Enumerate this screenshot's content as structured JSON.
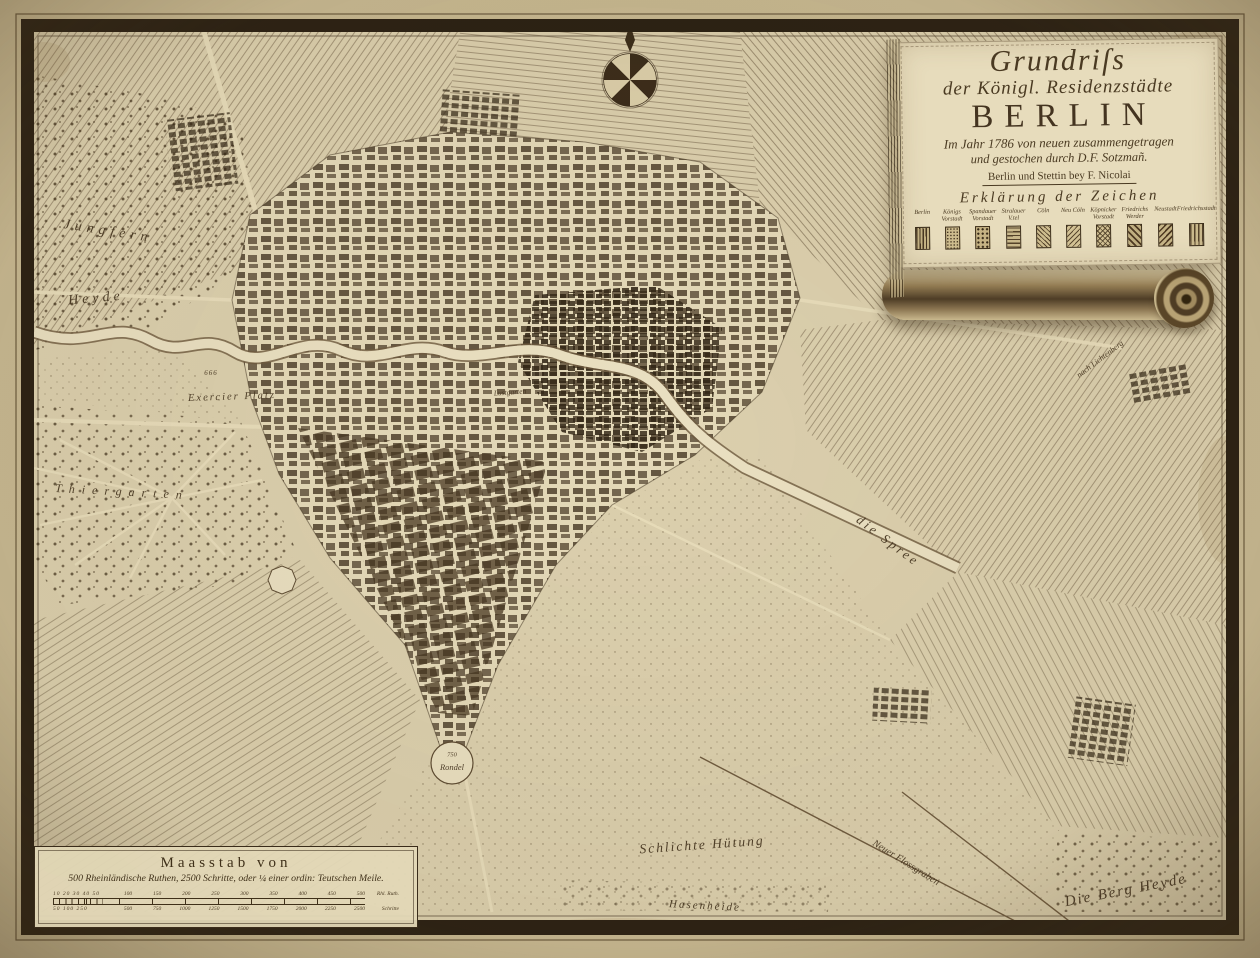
{
  "cartouche": {
    "title_line1": "Grundriſs",
    "title_line2": "der Königl. Residenzstädte",
    "title_line3": "BERLIN",
    "title_line4": "Im Jahr 1786 von neuen zusammengetragen",
    "title_line5": "und gestochen durch D.F. Sotzmañ.",
    "imprint": "Berlin und Stettin bey F. Nicolai",
    "legend_title": "Erklärung der Zeichen",
    "legend_items": [
      {
        "label": "Berlin"
      },
      {
        "label": "Königs Vorstadt"
      },
      {
        "label": "Spandauer Vorstadt"
      },
      {
        "label": "Stralauer V.tel"
      },
      {
        "label": "Cöln"
      },
      {
        "label": "Neu Cöln"
      },
      {
        "label": "Köpnicker Vorstadt"
      },
      {
        "label": "Friedrichs Werder"
      },
      {
        "label": "Neustadt"
      },
      {
        "label": "Friedrichsstadt"
      }
    ]
  },
  "scale_bar": {
    "title": "Maasstab von",
    "subtitle": "500 Rheinländische Ruthen, 2500 Schritte, oder ¼ einer ordin: Teutschen Meile.",
    "upper_minor": "10 20 30 40 50",
    "upper_ticks": [
      "100",
      "150",
      "200",
      "250",
      "300",
      "350",
      "400",
      "450",
      "500"
    ],
    "upper_unit": "Rhl. Ruth.",
    "lower_minor": "50 100 250",
    "lower_ticks": [
      "500",
      "750",
      "1000",
      "1250",
      "1500",
      "1750",
      "2000",
      "2250",
      "2500"
    ],
    "lower_unit": "Schritte"
  },
  "map_labels": [
    {
      "id": "jungfern",
      "text": "Jungfern"
    },
    {
      "id": "heyde",
      "text": "Heyde"
    },
    {
      "id": "thiergarten",
      "text": "Thiergarten"
    },
    {
      "id": "exercier-number",
      "text": "666"
    },
    {
      "id": "exercier-platz",
      "text": "Exercier Platz"
    },
    {
      "id": "lustgarten",
      "text": "Lustgarten"
    },
    {
      "id": "die-spree",
      "text": "die Spree"
    },
    {
      "id": "schlichte-huetung",
      "text": "Schlichte Hütung"
    },
    {
      "id": "neuer-flossgraben",
      "text": "Neuer Flossgraben"
    },
    {
      "id": "die-berg-heyde",
      "text": "Die Berg Heyde"
    },
    {
      "id": "hasenheide",
      "text": "Hasenheide"
    },
    {
      "id": "nach-lichtenberg",
      "text": "nach Lichtenberg"
    },
    {
      "id": "rondel-number",
      "text": "750"
    },
    {
      "id": "rondel",
      "text": "Rondel"
    }
  ],
  "compass": {
    "name": "compass-rose",
    "points": 8,
    "pointer": "north"
  },
  "colors": {
    "paper": "#dcd0ae",
    "paper_margin": "#c8b992",
    "frame": "#2a2013",
    "ink": "#42321d",
    "river": "#eae0c1",
    "city_blocks": "#4a3826"
  }
}
